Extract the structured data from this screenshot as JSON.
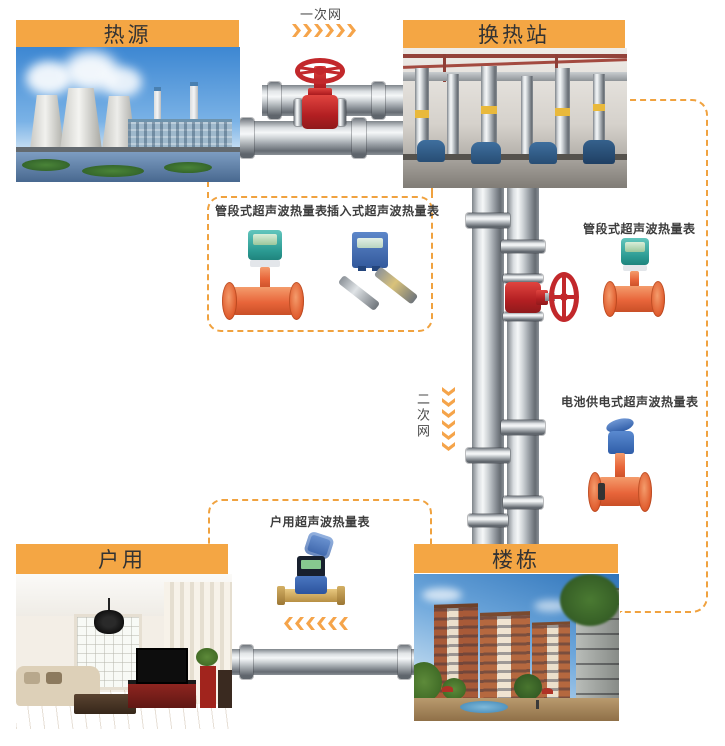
{
  "diagram_title_implicit": "超声波热量表供热网络示意图",
  "colors": {
    "accent_orange": "#F4A644",
    "dash_orange": "#F0A23F",
    "chevron_orange": "#F5A44A",
    "valve_red": "#C2282B",
    "meter_orange": "#E8653A",
    "meter_teal": "#2FA39B",
    "meter_blue": "#3A67B0",
    "brass": "#C9A257"
  },
  "network": {
    "primary_label": "一次网",
    "secondary_label": "二次网"
  },
  "panels": {
    "heat_source": {
      "title": "热源",
      "photo_desc": "power plant with cooling towers by water"
    },
    "exchange_station": {
      "title": "换热站",
      "photo_desc": "heat exchange station pump room with pipes"
    },
    "household": {
      "title": "户用",
      "photo_desc": "residential living room interior"
    },
    "building": {
      "title": "楼栋",
      "photo_desc": "apartment building complex with plaza"
    }
  },
  "meter_labels": {
    "pipe_section_a": "管段式超声波热量表",
    "insertion": "插入式超声波热量表",
    "pipe_section_b": "管段式超声波热量表",
    "battery": "电池供电式超声波热量表",
    "household": "户用超声波热量表"
  },
  "icons": {
    "primary_flow": "chevrons-right",
    "secondary_flow": "chevrons-down",
    "household_flow": "chevrons-left"
  }
}
